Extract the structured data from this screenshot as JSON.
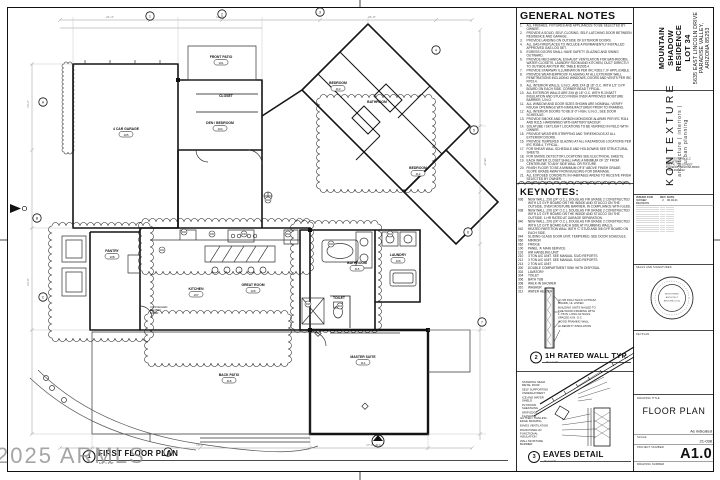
{
  "sheet": {
    "watermark": "2025 ARMLS"
  },
  "general_notes": {
    "title": "GENERAL NOTES",
    "items": [
      "ALL FINISHES, FIXTURES AND APPLIANCES TO BE SELECTED BY OWNER.",
      "PROVIDE A SOLID, SELF-CLOSING, SELF-LATCHING DOOR BETWEEN RESIDENCE AND GARAGE.",
      "PROVIDE LANDING ON OUTSIDE OF EXTERIOR DOORS.",
      "ALL GAS FIREPLACES TO INCLUDE A PERMANENTLY INSTALLED APPROVED GAS LOG SET.",
      "EGRESS DOORS SHALL HAVE SAFETY GLAZING AND SWING OUTWARD.",
      "PROVIDE MECHANICAL EXHAUST VENTILATION FOR BATHROOMS, WATER CLOSETS, LAUNDRY ROOM AND KITCHEN, DUCT DIRECTLY TO OUTSIDE AIR PER IRC TABLE M1505.4.",
      "PROVIDE STAIRWAY ILLUMINATION PER IRC R303.7, IF APPLICABLE.",
      "PROVIDE WEATHERPROOF FLASHING AT ALL EXTERIOR WALL PENETRATIONS INCLUDING WINDOWS, DOORS AND VENTS PER IRC R703.4.",
      "ALL INTERIOR WALLS, U.N.O., ARE 2X4 @ 16\" O.C. WITH 1/2\" GYP. BOARD ON EACH SIDE, CORNER BEAD TYPICAL.",
      "ALL EXTERIOR WALLS ARE 2X6 @ 16\" O.C. WITH R-19 BATT INSULATION AND STUCCO FINISH OVER APPROVED MOISTURE BARRIER, U.N.O.",
      "ALL WINDOW AND DOOR SIZES SHOWN ARE NOMINAL; VERIFY ROUGH OPENINGS WITH MANUFACTURER PRIOR TO FRAMING.",
      "ALL INTERIOR DOORS TO BE 8'-0\" HIGH, U.N.O., SEE DOOR SCHEDULE.",
      "PROVIDE SMOKE AND CARBON MONOXIDE ALARMS PER IRC R314 AND R315, HARDWIRED WITH BATTERY BACKUP.",
      "SOLATUBE / SKYLIGHT LOCATIONS TO BE VERIFIED IN FIELD WITH OWNER.",
      "PROVIDE WEATHER-STRIPPING AND THRESHOLDS AT ALL EXTERIOR DOORS.",
      "PROVIDE TEMPERED GLAZING AT ALL HAZARDOUS LOCATIONS PER IRC R308.4, TYPICAL.",
      "FOR SHEAR WALL SCHEDULE AND HOLDOWNS SEE STRUCTURAL SHEETS.",
      "FOR SMOKE DETECTOR LOCATIONS SEE ELECTRICAL SHEETS.",
      "EACH WATER CLOSET SHALL HAVE A MINIMUM OF 15\" FROM CENTERLINE TO ANY SIDE WALL OR FIXTURE.",
      "FINISH FLOOR TO BE A MINIMUM OF 8\" ABOVE FINISH GRADE; SLOPE GRADE AWAY FROM BUILDING FOR DRAINAGE.",
      "ALL EXPOSED CONCRETE IN HABITABLE AREAS TO RECEIVE FINISH SELECTED BY OWNER.",
      "FINISH FLOOR IN THE GARAGE TO BE SEALED CONCRETE, SLOPE TO DOOR.",
      "PROVIDE HOSE BIBBS WITH ANTI-SIPHON DEVICES, SEE PLUMBING SHEETS.",
      "ALL EXTERIOR LIGHTING SHALL COMPLY WITH TOWN DARK SKY ORDINANCE AND BE FULLY SHIELDED."
    ]
  },
  "keynotes": {
    "title": "KEYNOTES:",
    "items": [
      {
        "code": "036",
        "text": "NEW WALL, 2X6 (24\" O.C.), DOUGLAS FIR GRADE 2 CONSTRUCTED WITH 1/2 GYP. BOARD ON THE INSIDE AND STUCCO ON THE OUTSIDE, OVER MOISTURE BARRIER, IN COMPLIANCE WITH GLBS."
      },
      {
        "code": "038",
        "text": "NEW WALL, 2X6 (24\" O.C.), DOUGLAS FIR GRADE 2 CONSTRUCTED WITH 1/2 GYP. BOARD ON THE INSIDE AND STUCCO ON THE OUTSIDE, 1-HR RATED AT GARAGE SEPARATION."
      },
      {
        "code": "040",
        "text": "NEW WALL, 2X6 (24\" O.C.), DOUGLAS FIR GRADE 2 CONSTRUCTED WITH 1/2 GYP. BOARD EACH SIDE AT PLUMBING WALLS."
      },
      {
        "code": "042",
        "text": "HEATED PARTITION WALL WITH 'C' STUD AND 5/8 GYP. BOARD ON EACH SIDE."
      },
      {
        "code": "044",
        "text": "SLIDING GLASS DOOR UNIT, TEMPERED, SEE DOOR SCHEDULE."
      },
      {
        "code": "060",
        "text": "MIRROR"
      },
      {
        "code": "062",
        "text": "FRIDGE"
      },
      {
        "code": "100",
        "text": "PANEL 'A' MAIN SERVICE"
      },
      {
        "code": "102",
        "text": "AIR HANDLING UNIT"
      },
      {
        "code": "210",
        "text": "3 TON A/C UNIT. SEE MANUAL S/J/D REPORTS"
      },
      {
        "code": "212",
        "text": "3 TON A/C UNIT. SEE MANUAL S/J/D REPORTS"
      },
      {
        "code": "214",
        "text": "2 TON A/C UNIT"
      },
      {
        "code": "300",
        "text": "DOUBLE COMPARTMENT SINK WITH DISPOSAL"
      },
      {
        "code": "302",
        "text": "LAVATORY"
      },
      {
        "code": "304",
        "text": "TOILET"
      },
      {
        "code": "306",
        "text": "BATH TUB"
      },
      {
        "code": "308",
        "text": "WALK-IN SHOWER"
      },
      {
        "code": "310",
        "text": "WASHER"
      },
      {
        "code": "312",
        "text": "WATER HEATER"
      }
    ]
  },
  "details": {
    "floor_plan": {
      "number": "1",
      "title": "FIRST FLOOR PLAN",
      "scale": "1/4\" = 1'-0\""
    },
    "rated_wall": {
      "number": "2",
      "title": "1H RATED WALL TYP.",
      "scale": "3\" = 1'-0\"",
      "callouts": [
        "(2) 5/8 INCH THICK GYPSUM BOARD, UL LISTED",
        "BUILDING UNITS NAILED TO THE WOOD FRAMING WITH 1-7/8 IN. LONG 6d NAILS, SPACED 6 IN. O.C.",
        "WOOD FRAMING WALL",
        "HI-DENSITY INSULATION"
      ]
    },
    "eaves": {
      "number": "3",
      "title": "EAVES DETAIL",
      "scale": "3\" = 1'-0\"",
      "callouts_top": [
        "STANDING SEAM METAL ROOF",
        "SELF SUPPORTING UNDERLAYMENT",
        "ICE AND WATER SHIELD",
        "PLYWOOD SHEATHING",
        "DRIP EDGE FLASHING"
      ],
      "callouts_bottom": [
        "GUTTER / TRAILING EDGE FRAMING",
        "EAVES VENTILATION",
        "RIGID PANEL W/ FUNCTIONAL INSULATION",
        "WALL MOISTURE BARRIER"
      ]
    }
  },
  "title_block": {
    "project_name_lines": [
      "MOUNTAIN SHADOW",
      "RESIDENCE",
      "LOT 34"
    ],
    "project_address_lines": [
      "5635 EAST LINCOLN DRIVE",
      "PARADISE VALLEY, ARIZONA 85253"
    ],
    "firm_name": "KONTEXTURE",
    "firm_tagline": "architecture  |  interiors  |  urban planning",
    "firm_info_lines": [
      "KONTEXTURE, LLC",
      "ARCHITECT",
      "1817 N. 7TH STREET",
      "PHOENIX, ARIZONA 85006",
      "P 602.462.1122"
    ],
    "issue_table": {
      "headers": [
        "ISSUED FOR",
        "REV",
        "DATE"
      ],
      "rows": [
        [
          "OWNER REVISION",
          "2",
          "06.04.21"
        ]
      ],
      "empty_rows": 12
    },
    "seals_label": "SEALS AND SIGNATURES",
    "seal_lines": [
      "REGISTERED",
      "ARCHITECT",
      "ARIZONA U.S.A."
    ],
    "keyplan_label": "KEYPLAN",
    "drawing_title_label": "DRAWING TITLE",
    "drawing_title": "FLOOR PLAN",
    "scale_label": "SCALE",
    "scale_value": "As indicated",
    "project_number_label": "PROJECT NUMBER",
    "project_number": "21-038",
    "drawing_number_label": "DRAWING NUMBER",
    "drawing_number": "A1.0"
  },
  "floor_plan": {
    "rooms": [
      {
        "key": "garage",
        "label": "4 CAR GARAGE",
        "tag": "105"
      },
      {
        "key": "front-patio",
        "label": "FRONT PATIO",
        "tag": "101"
      },
      {
        "key": "closet-den",
        "label": "CLOSET",
        "tag": ""
      },
      {
        "key": "den",
        "label": "DEN / BEDROOM",
        "tag": "104"
      },
      {
        "key": "bedroom-2",
        "label": "BEDROOM",
        "tag": "110"
      },
      {
        "key": "bathroom-2",
        "label": "BATHROOM",
        "tag": ""
      },
      {
        "key": "bedroom-3",
        "label": "BEDROOM",
        "tag": "112"
      },
      {
        "key": "pantry",
        "label": "PANTRY",
        "tag": "108"
      },
      {
        "key": "kitchen",
        "label": "KITCHEN",
        "tag": "107"
      },
      {
        "key": "great-room",
        "label": "GREAT ROOM",
        "tag": "106"
      },
      {
        "key": "bathroom",
        "label": "BATHROOM",
        "tag": "115"
      },
      {
        "key": "laundry",
        "label": "LAUNDRY",
        "tag": "109"
      },
      {
        "key": "toilet",
        "label": "TOILET",
        "tag": ""
      },
      {
        "key": "master",
        "label": "MASTER SUITE",
        "tag": "114"
      },
      {
        "key": "back-patio",
        "label": "BACK PATIO",
        "tag": "118"
      }
    ],
    "annotations": [
      {
        "key": "pantry-door",
        "text": "CONCEALED\nPANTRY\nDOOR"
      }
    ],
    "grid_bubbles": [
      "1",
      "2",
      "3",
      "4",
      "A",
      "B",
      "C",
      "5",
      "6",
      "7",
      "8"
    ],
    "keynote_refs": [
      "036",
      "040",
      "062",
      "100",
      "300",
      "304",
      "306",
      "308",
      "310",
      "042"
    ],
    "section_marker": "A7.1",
    "dimension_labels": [
      "21'-4\"",
      "12'-8\"",
      "31'-6\"",
      "16'-2\"",
      "24'-0\"",
      "28'-8\"",
      "18'-4\"",
      "17'-8\""
    ]
  }
}
